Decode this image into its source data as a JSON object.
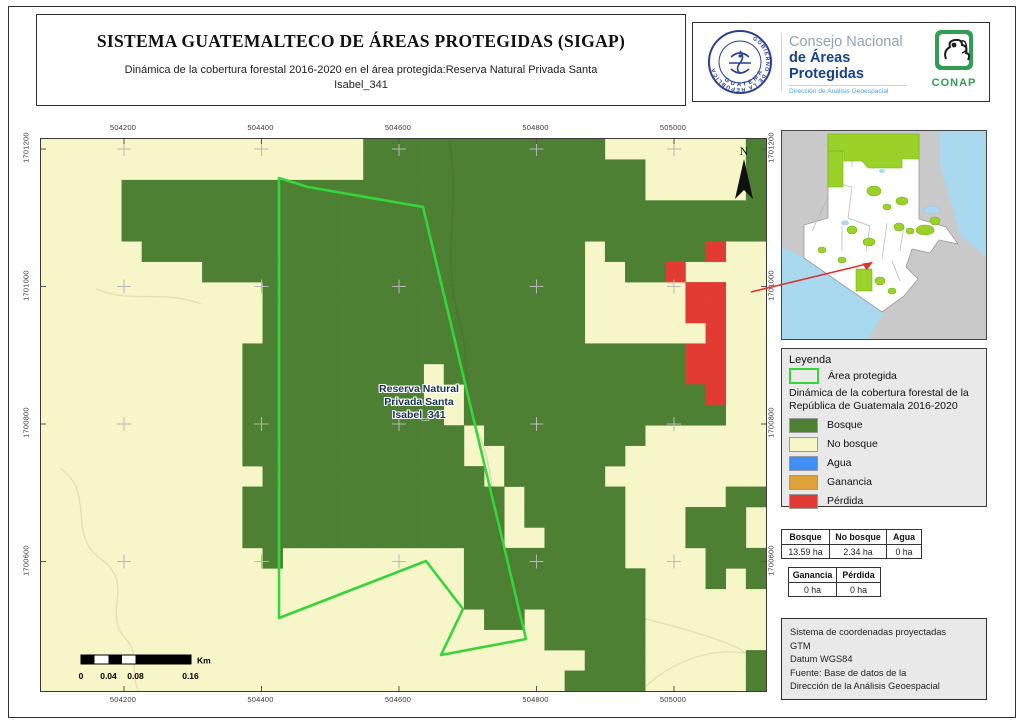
{
  "header": {
    "title": "SISTEMA GUATEMALTECO DE ÁREAS PROTEGIDAS  (SIGAP)",
    "subtitle_line1": "Dinámica de la cobertura forestal 2016-2020 en el área protegida:Reserva Natural Privada Santa",
    "subtitle_line2": "Isabel_341"
  },
  "logos": {
    "seal_top_text": "GOBIERNO DE LA REPÚBLICA",
    "seal_bottom_text": "GUATEMALA",
    "org_line1": "Consejo Nacional",
    "org_line2": "de Áreas Protegidas",
    "org_line3": "Dirección de Análisis Geoespacial",
    "conap_label": "CONAP"
  },
  "map": {
    "x_ticks": [
      "504200",
      "504400",
      "504600",
      "504800",
      "505000"
    ],
    "y_ticks": [
      "1701200",
      "1701000",
      "1700800",
      "1700600"
    ],
    "x_ticks_px": [
      83,
      220.5,
      358,
      495.5,
      633
    ],
    "y_ticks_px": [
      10,
      147.5,
      285,
      422.5
    ],
    "north_label": "N",
    "area_label_lines": [
      "Reserva Natural",
      "Privada Santa",
      "Isabel_341"
    ],
    "scalebar": {
      "labels": [
        "0",
        "0.04",
        "0.08",
        "0.16"
      ],
      "labels_px": [
        40,
        67.5,
        94.5,
        149.5
      ],
      "unit": "Km"
    },
    "grid_rows": [
      "NNNNNNNNNNNNNNNNFFFFFFFFFFFFNNNNNNNF",
      "NNNNNNNNNNNNNNNNFFFFFFFFFFFFFFNNNNNF",
      "NNNNFFFFFFFFFFFFFFFFFFFFFFFFFFNNNNNF",
      "NNNNFFFFFFFFFFFFFFFFFFFFFFFFFFFFFFFF",
      "NNNNFFFFFFFFFFFFFFFFFFFFFFFFFFFFFFFF",
      "NNNNNFFFFFFFFFFFFFFFFFFFFFFNFFFFFRNN",
      "NNNNNNNNFFFFFFFFFFFFFFFFFFFNNFFRNNNN",
      "NNNNNNNNNNNFFFFFFFFFFFFFFFFNNNNNRRNN",
      "NNNNNNNNNNNFFFFFFFFFFFFFFFFNNNNNRRNN",
      "NNNNNNNNNNNFFFFFFFFFFFFFFFFNNNNNNRNN",
      "NNNNNNNNNNFFFFFFFFFFFFFFFFFFFFFFRRNN",
      "NNNNNNNNNNFFFFFFFFFNFFFFFFFFFFFFRRNN",
      "NNNNNNNNNNFFFFFFFFFNNFFFFFFFFFFFFRNN",
      "NNNNNNNNNNFFFFFFFFFFNFFFFFFFFFFFFFNN",
      "NNNNNNNNNNFFFFFFFFFFFNFFFFFFFFNNNNNN",
      "NNNNNNNNNNFFFFFFFFFFFNNFFFFFFNNNNNNN",
      "NNNNNNNNNNNFFFFFFFFFFFNFFFFFNNNNNNNN",
      "NNNNNNNNNNFFFFFFFFFFFFFNFFFFFNNNNNFF",
      "NNNNNNNNNNFFFFFFFFFFFFFNFFFFFNNNFFFN",
      "NNNNNNNNNNFFFFFFFFFFFFFNNFFFFNNNFFFN",
      "NNNNNNNNNNNFNNNNNNNNNFFFFFFFFNNNNFFF",
      "NNNNNNNNNNNNNNNNNNNNNFFFFFFFFFNNNFNF",
      "NNNNNNNNNNNNNNNNNNNNNFFFFFFFFFNNNNNN",
      "NNNNNNNNNNNNNNNNNNNNNNFFNFFFFFNNNNNN",
      "NNNNNNNNNNNNNNNNNNNNNNNNNFFFFFNNNNNN",
      "NNNNNNNNNNNNNNNNNNNNNNNNNNNFFFNNNNNF",
      "NNNNNNNNNNNNNNNNNNNNNNNNNNFFFFNNNNNF"
    ],
    "protected_polygon": "238,39 267,48 382,68 485,500 400,516 422,470 385,422 238,479",
    "colors": {
      "bosque": "#4d8033",
      "no_bosque": "#f6f6c9",
      "agua": "#3f8df5",
      "ganancia": "#dfa23a",
      "perdida": "#e23b33",
      "area_protegida": "#36d53c",
      "contour": "#e7dfb4",
      "grid_cross": "#b8b8b8",
      "inset_protected": "#9ad22a",
      "inset_water": "#a9d9ef",
      "leader_red": "#e03030"
    }
  },
  "legend": {
    "title": "Leyenda",
    "area_item_label": "Área protegida",
    "subtitle_line1": "Dinámica de la cobertura forestal de la",
    "subtitle_line2": "República de Guatemala 2016-2020",
    "items": [
      {
        "key": "bosque",
        "label": "Bosque",
        "color": "#4d8033"
      },
      {
        "key": "no-bosque",
        "label": "No bosque",
        "color": "#f6f6c9"
      },
      {
        "key": "agua",
        "label": "Agua",
        "color": "#3f8df5"
      },
      {
        "key": "ganancia",
        "label": "Ganancia",
        "color": "#dfa23a"
      },
      {
        "key": "perdida",
        "label": "Pérdida",
        "color": "#e23b33"
      }
    ]
  },
  "tables": {
    "table1": {
      "headers": [
        "Bosque",
        "No bosque",
        "Agua"
      ],
      "values": [
        "13.59 ha",
        "2.34 ha",
        "0 ha"
      ]
    },
    "table2": {
      "headers": [
        "Ganancia",
        "Pérdida"
      ],
      "values": [
        "0 ha",
        "0 ha"
      ]
    }
  },
  "info_box": {
    "lines": [
      "Sistema de coordenadas proyectadas",
      "GTM",
      "Datum WGS84",
      "Fuente: Base de datos de la",
      "Dirección de la Análisis Geoespacial"
    ]
  }
}
